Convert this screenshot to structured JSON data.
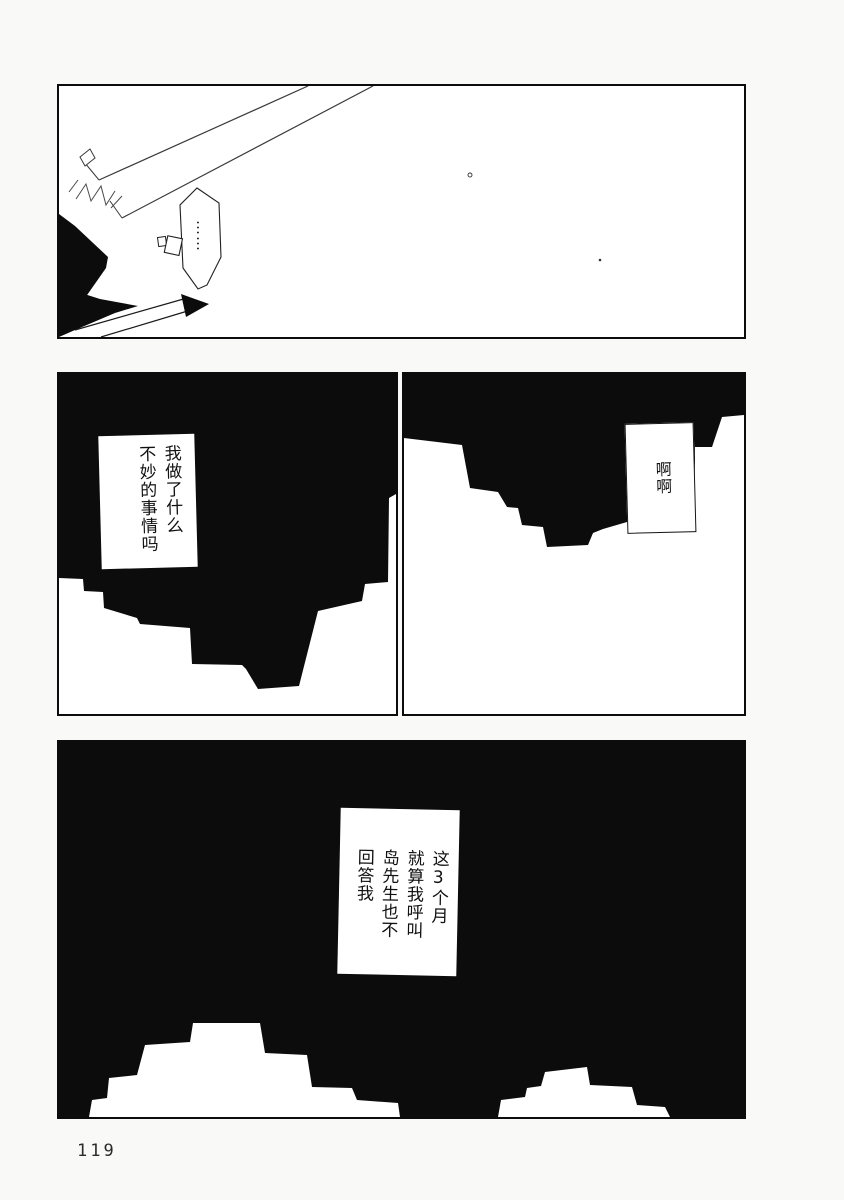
{
  "page": {
    "number": "119"
  },
  "colors": {
    "ink": "#0c0c0c",
    "paper": "#ffffff"
  },
  "panel1": {
    "bubble_text": "……"
  },
  "panel2": {
    "caption_lines": [
      "我做了什么",
      "不妙的事情吗"
    ]
  },
  "panel3": {
    "caption_lines": [
      "啊啊"
    ]
  },
  "panel4": {
    "caption_lines": [
      "这3个月",
      "就算我呼叫",
      "岛先生也不",
      "回答我"
    ]
  }
}
